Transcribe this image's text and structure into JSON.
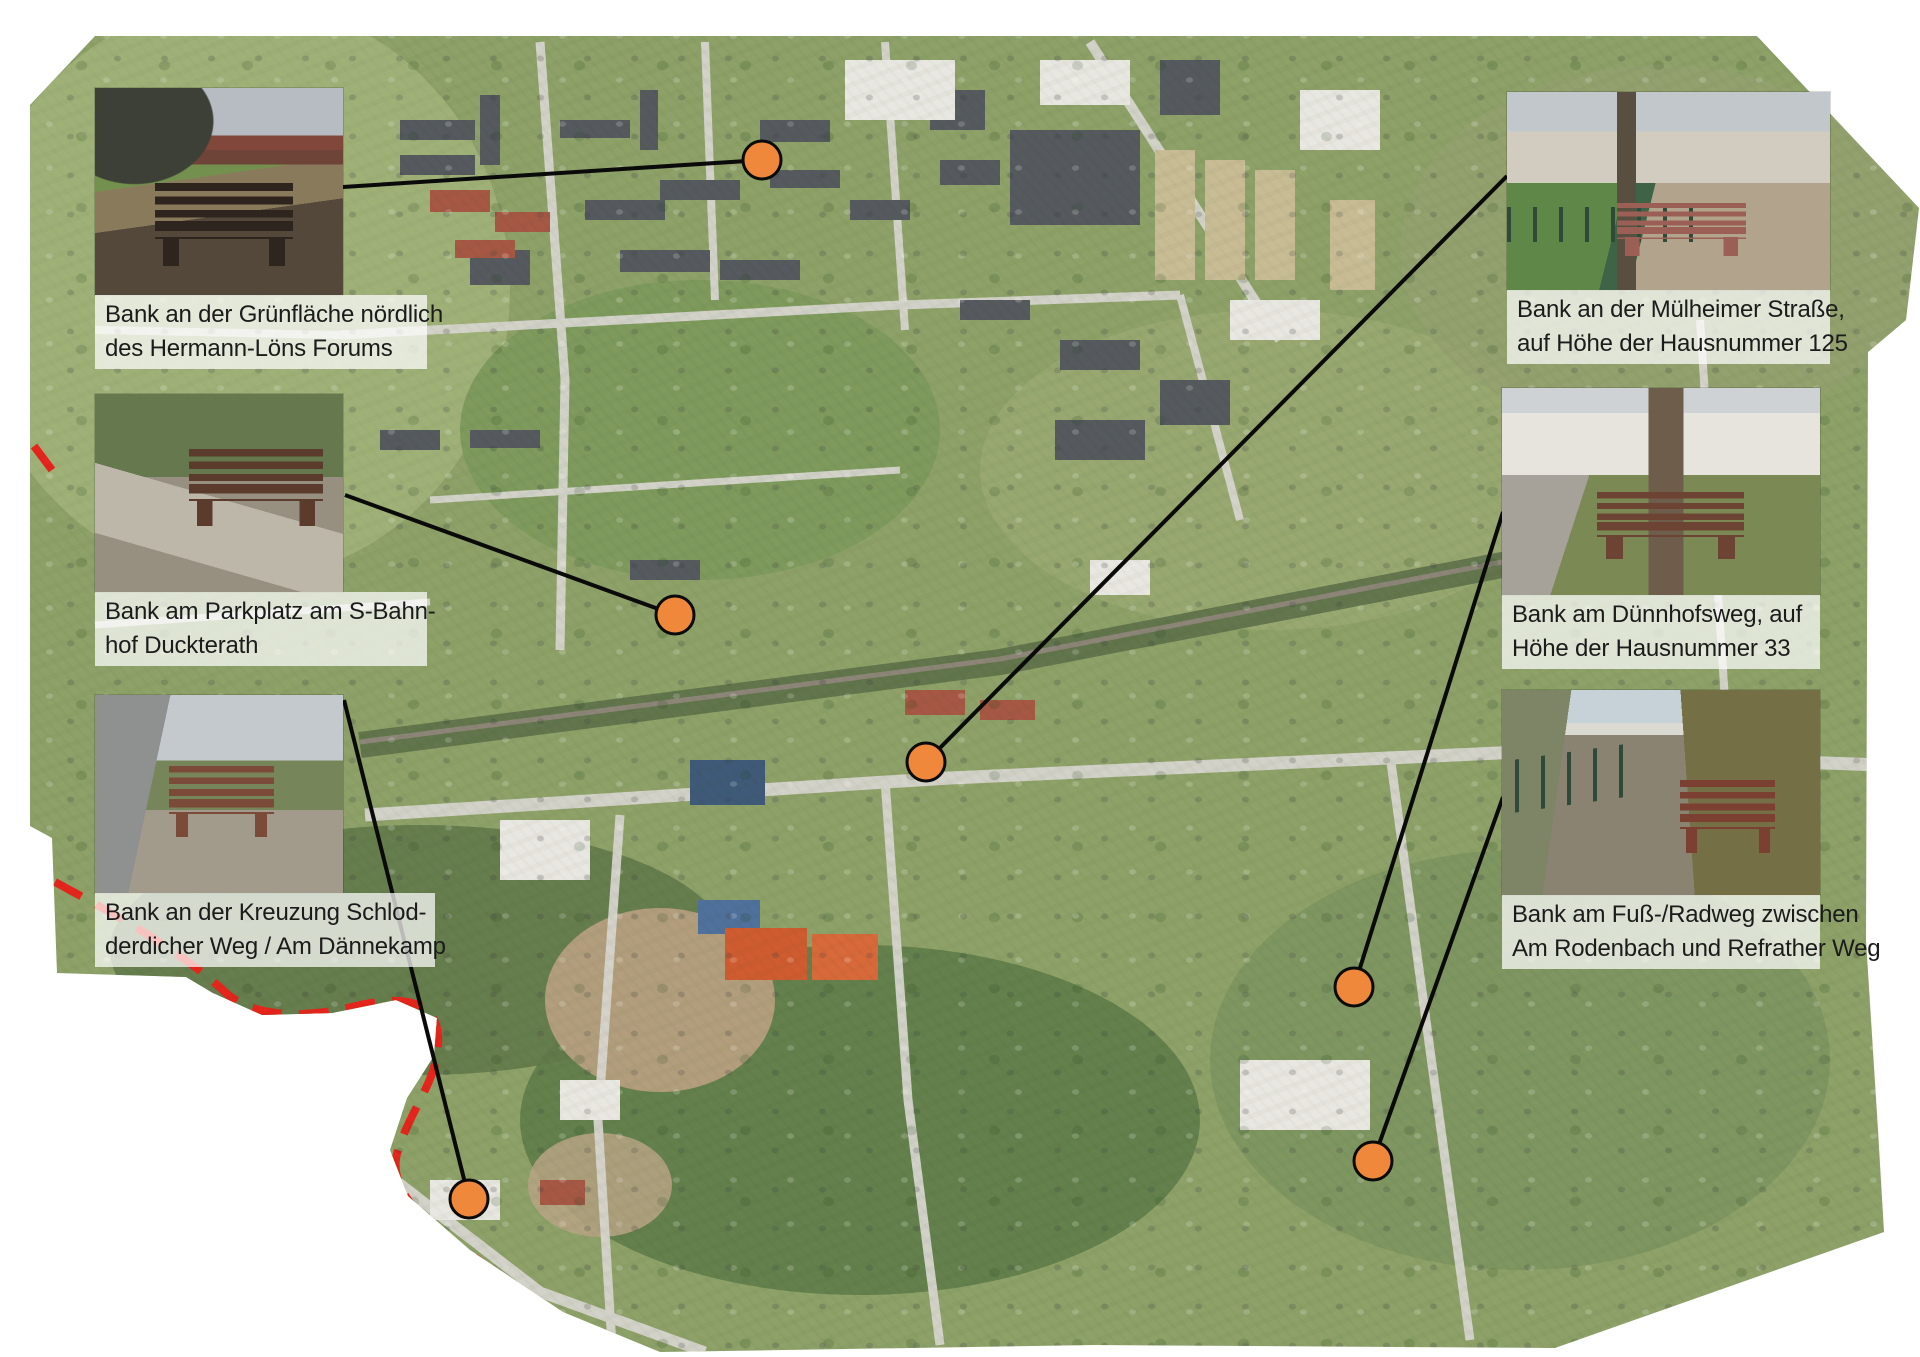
{
  "page": {
    "kind": "bench-location-aerial-map"
  },
  "colors": {
    "marker_fill": "#F0883B",
    "marker_stroke": "#0B0B0B",
    "connector_line": "#0A0A0A",
    "boundary_dash_red": "#E6251C",
    "caption_text": "#1B1B1B",
    "caption_background": "rgba(255,255,255,0.72)"
  },
  "benches": [
    {
      "id": "gruenflaeche-hermann-loens",
      "line1": "Bank an der Grünfläche nördlich",
      "line2": "des Hermann-Löns Forums"
    },
    {
      "id": "parkplatz-s-bahnhof-duckterath",
      "line1": "Bank am Parkplatz am S-Bahn-",
      "line2": "hof Duckterath"
    },
    {
      "id": "kreuzung-schlodderdicher-weg",
      "line1": "Bank an der Kreuzung Schlod-",
      "line2": "derdicher Weg / Am Dännekamp"
    },
    {
      "id": "muelheimer-strasse-125",
      "line1": "Bank an der Mülheimer Straße,",
      "line2": "auf Höhe der Hausnummer 125"
    },
    {
      "id": "duennhofsweg-33",
      "line1": "Bank am Dünnhofsweg, auf",
      "line2": "Höhe der Hausnummer 33"
    },
    {
      "id": "fuss-radweg-rodenbach-refrather-weg",
      "line1": "Bank am Fuß-/Radweg zwischen",
      "line2": "Am Rodenbach und Refrather Weg"
    }
  ],
  "markers": [
    {
      "id": 1,
      "bench": "gruenflaeche-hermann-loens"
    },
    {
      "id": 2,
      "bench": "parkplatz-s-bahnhof-duckterath"
    },
    {
      "id": 3,
      "bench": "muelheimer-strasse-125"
    },
    {
      "id": 4,
      "bench": "duennhofsweg-33"
    },
    {
      "id": 5,
      "bench": "fuss-radweg-rodenbach-refrather-weg"
    },
    {
      "id": 6,
      "bench": "kreuzung-schlodderdicher-weg"
    }
  ]
}
